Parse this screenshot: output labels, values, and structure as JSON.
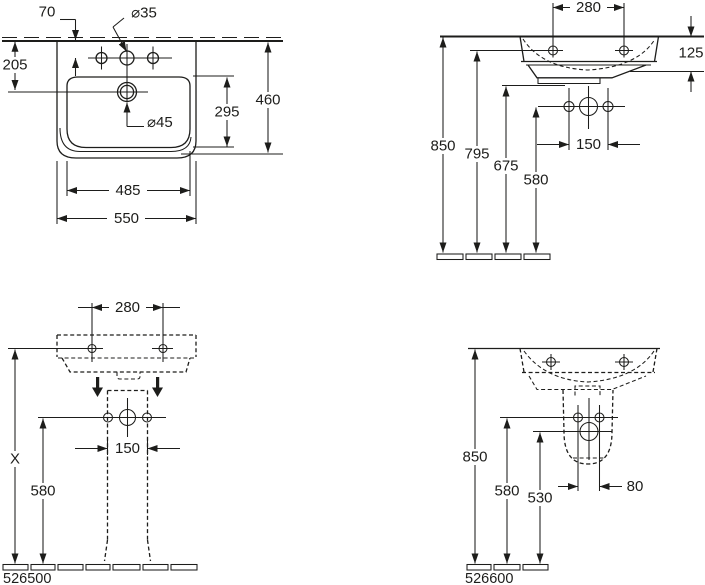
{
  "drawing": {
    "background": "#ffffff",
    "line_color": "#1d1d1b"
  },
  "views": {
    "plan": {
      "dims": {
        "wall_offset": "70",
        "tap_hole_dia": "⌀35",
        "drain_setback": "205",
        "drain_dia": "⌀45",
        "inner_depth": "295",
        "depth": "460",
        "inner_width": "485",
        "width": "550"
      }
    },
    "front": {
      "dims": {
        "fixing_centres": "280",
        "rim_drop": "125",
        "rim_height": "850",
        "fixing_height": "795",
        "waste_height": "675",
        "supply_height": "580",
        "supply_centres": "150"
      }
    },
    "pedestal": {
      "article_number": "526500",
      "dims": {
        "fixing_centres": "280",
        "height_x": "X",
        "supply_height": "580",
        "supply_centres": "150"
      }
    },
    "semi_pedestal": {
      "article_number": "526600",
      "dims": {
        "rim_height": "850",
        "supply_height": "580",
        "waste_height": "530",
        "waste_offset": "80"
      }
    }
  }
}
